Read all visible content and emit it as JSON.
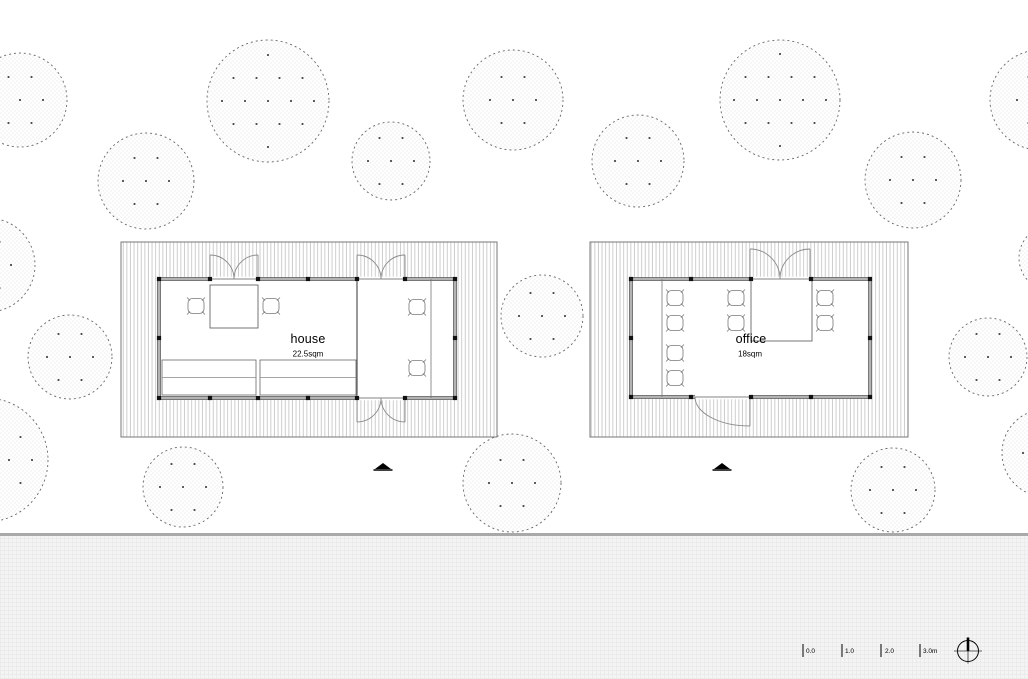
{
  "palette": {
    "ink": "#111111",
    "wall_gray": "#b3b3b3",
    "wall_edge": "#5a5a5a",
    "deck_hatch": "#c8c8c8",
    "deck_edge": "#777777",
    "tree_outline": "#666666",
    "tree_dot": "#3a3a3a",
    "stipple": "#d6d6d6",
    "band_gray": "#a9a9a9",
    "surface_gray": "#f4f4f4",
    "furniture_line": "#777777"
  },
  "plan": {
    "trees": [
      {
        "cx": 20,
        "cy": 100,
        "r": 47
      },
      {
        "cx": 268,
        "cy": 101,
        "r": 61
      },
      {
        "cx": 146,
        "cy": 181,
        "r": 48
      },
      {
        "cx": 391,
        "cy": 161,
        "r": 39
      },
      {
        "cx": 513,
        "cy": 100,
        "r": 50
      },
      {
        "cx": 638,
        "cy": 161,
        "r": 46
      },
      {
        "cx": 780,
        "cy": 100,
        "r": 60
      },
      {
        "cx": 913,
        "cy": 180,
        "r": 48
      },
      {
        "cx": 1040,
        "cy": 100,
        "r": 50
      },
      {
        "cx": -12,
        "cy": 265,
        "r": 47
      },
      {
        "cx": 70,
        "cy": 357,
        "r": 42
      },
      {
        "cx": -14,
        "cy": 460,
        "r": 62
      },
      {
        "cx": 542,
        "cy": 316,
        "r": 41
      },
      {
        "cx": 988,
        "cy": 357,
        "r": 39
      },
      {
        "cx": 1052,
        "cy": 258,
        "r": 33
      },
      {
        "cx": 1046,
        "cy": 453,
        "r": 44
      },
      {
        "cx": 183,
        "cy": 487,
        "r": 40
      },
      {
        "cx": 512,
        "cy": 483,
        "r": 49
      },
      {
        "cx": 893,
        "cy": 490,
        "r": 42
      }
    ],
    "buildings": [
      {
        "name": "house",
        "label": "house",
        "area_label": "22.5sqm",
        "deck": [
          121,
          242,
          376,
          195
        ],
        "room": [
          159,
          279,
          296,
          119
        ],
        "posts_x": [
          159,
          210,
          258,
          308,
          357,
          405,
          455
        ],
        "side_post_y": 338,
        "partitions": [
          {
            "x": 357,
            "y1": 279,
            "y2": 398
          }
        ],
        "desk_lines": [
          {
            "x": 431,
            "y1": 279,
            "y2": 398
          }
        ],
        "tables": [
          [
            210,
            285,
            48,
            43
          ]
        ],
        "benches": [
          [
            162,
            360,
            94,
            35
          ],
          [
            260,
            360,
            96,
            35
          ]
        ],
        "chairs": [
          [
            196,
            306
          ],
          [
            271,
            306
          ],
          [
            417,
            307
          ],
          [
            417,
            368
          ]
        ],
        "doors": [
          {
            "type": "double",
            "cx": 234,
            "y": 279,
            "half": 24,
            "dir": "up"
          },
          {
            "type": "double",
            "cx": 381,
            "y": 279,
            "half": 24,
            "dir": "up"
          },
          {
            "type": "double",
            "cx": 381,
            "y": 398,
            "half": 24,
            "dir": "down"
          }
        ],
        "marker": [
          383,
          466
        ],
        "label_pos": [
          308,
          339
        ],
        "area_pos": [
          308,
          354
        ]
      },
      {
        "name": "office",
        "label": "office",
        "area_label": "18sqm",
        "deck": [
          590,
          242,
          318,
          195
        ],
        "room": [
          631,
          279,
          239,
          118
        ],
        "posts_x": [
          631,
          691,
          751,
          811,
          870
        ],
        "side_post_y": 338,
        "partitions": [],
        "desk_lines": [
          {
            "x": 662,
            "y1": 279,
            "y2": 397
          }
        ],
        "tables": [
          [
            751,
            279,
            61,
            62
          ]
        ],
        "benches": [],
        "chairs": [
          [
            675,
            298
          ],
          [
            675,
            323
          ],
          [
            675,
            353
          ],
          [
            675,
            378
          ],
          [
            736,
            298
          ],
          [
            736,
            323
          ],
          [
            825,
            298
          ],
          [
            825,
            323
          ]
        ],
        "doors": [
          {
            "type": "double",
            "cx": 780,
            "y": 279,
            "half": 30,
            "dir": "up"
          },
          {
            "type": "single",
            "jx": 695,
            "hx": 750,
            "y": 397,
            "depth": 29
          }
        ],
        "marker": [
          722,
          466
        ],
        "label_pos": [
          751,
          339
        ],
        "area_pos": [
          750,
          354
        ]
      }
    ],
    "scale_bar": {
      "x0": 803,
      "dx": 39,
      "tick_top": 644,
      "tick_bottom": 657,
      "labels": [
        "0.0",
        "1.0",
        "2.0",
        "3.0m"
      ]
    },
    "north": {
      "cx": 968,
      "cy": 651,
      "r": 10.5
    }
  }
}
